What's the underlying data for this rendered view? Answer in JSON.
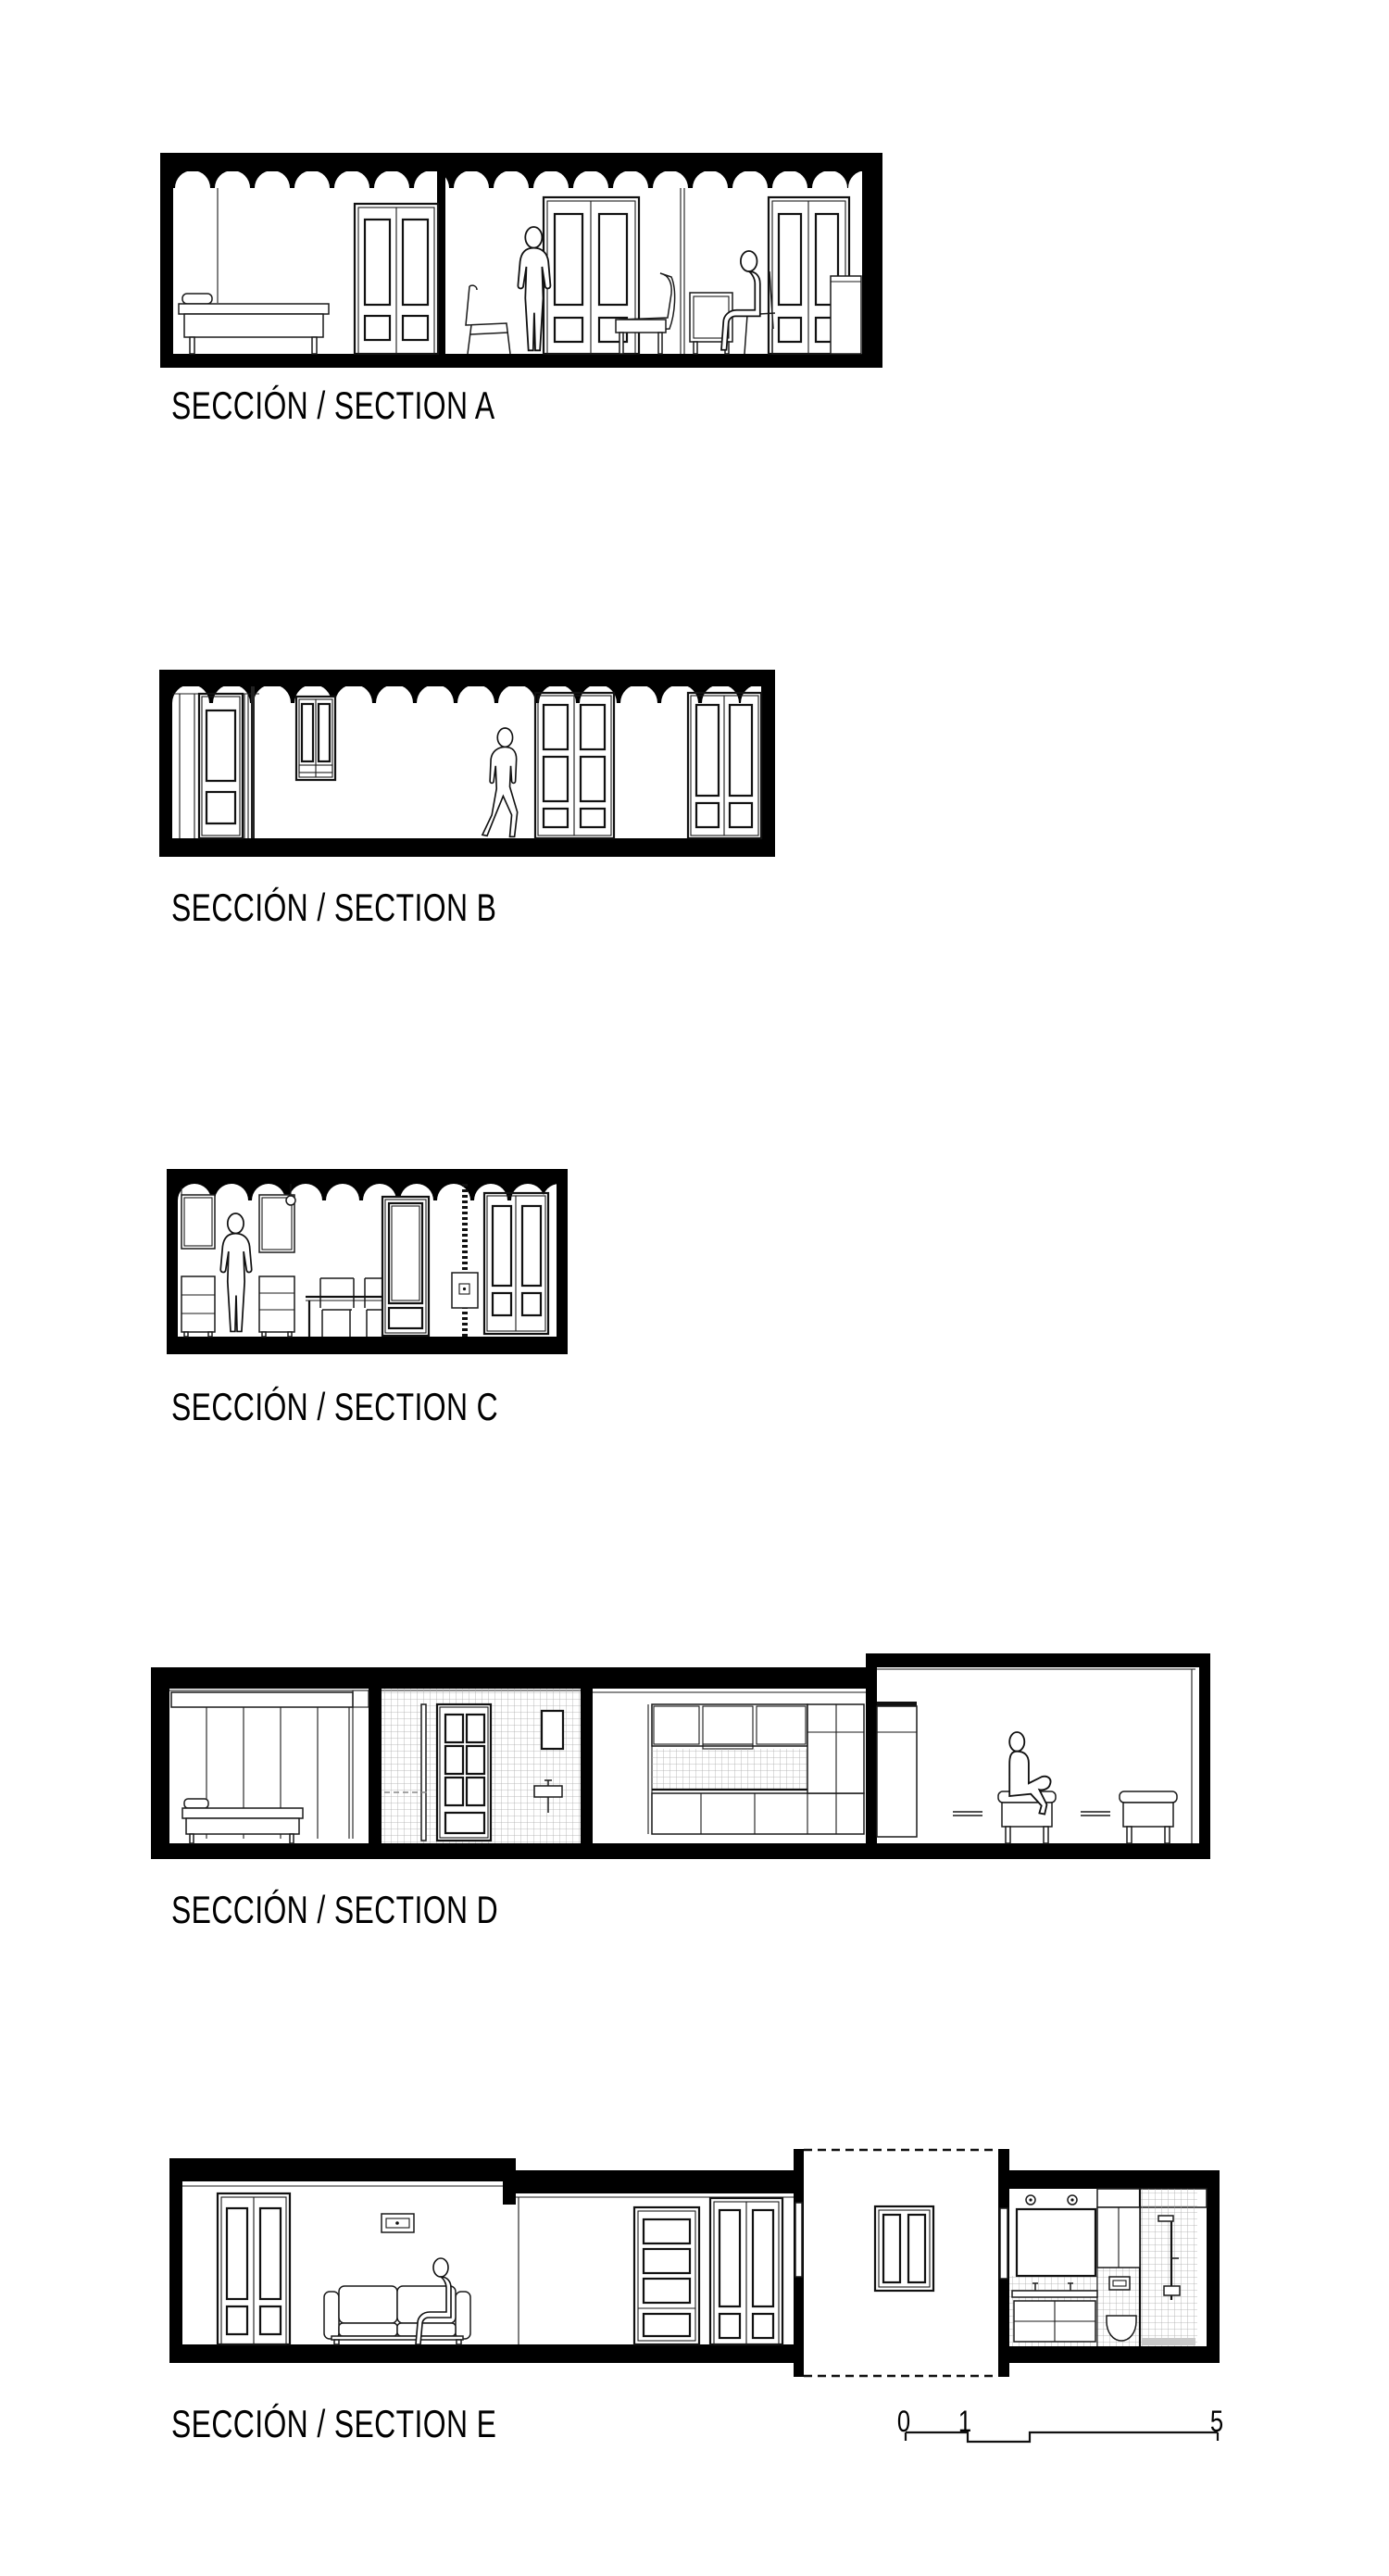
{
  "page": {
    "background": "#ffffff",
    "ink": "#000000",
    "thin_line": "#1a1a1a",
    "tile_line": "#aaaaaa"
  },
  "figures": [
    {
      "id": "A",
      "caption": "SECCIÓN / SECTION A"
    },
    {
      "id": "B",
      "caption": "SECCIÓN / SECTION B"
    },
    {
      "id": "C",
      "caption": "SECCIÓN / SECTION C"
    },
    {
      "id": "D",
      "caption": "SECCIÓN / SECTION D"
    },
    {
      "id": "E",
      "caption": "SECCIÓN / SECTION E"
    }
  ],
  "scale_bar": {
    "tick_start": "0",
    "tick_one": "1",
    "tick_end": "5"
  }
}
